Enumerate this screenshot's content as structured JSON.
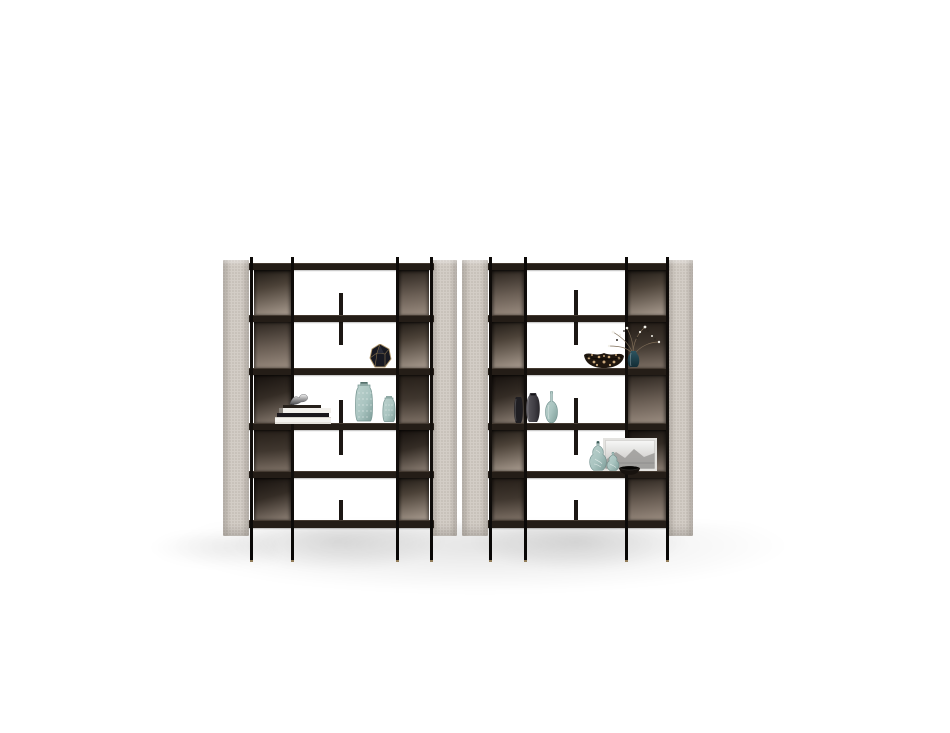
{
  "scene": {
    "type": "product-render",
    "subject": "Two modular open bookshelf units with upholstered side panels, bronze smoked-mirror back panels, slim black metal posts and staggered divider tabs, styled with decor objects, on a white studio background",
    "units_count": 2,
    "shelves_per_unit": 6,
    "rows_per_unit": 5,
    "posts_per_unit": 4,
    "divider_tabs_per_unit": 3
  },
  "colors": {
    "background": "#ffffff",
    "side_panel": "#d3cdc6",
    "side_panel_edge": "#b9b2aa",
    "shelf": "#241d17",
    "shelf_highlight": "#443a31",
    "post": "#14100d",
    "bronze_dark": "#1f1a15",
    "bronze_mid": "#6b5f55",
    "bronze_light": "#a3968a",
    "gold_trim": "#b49a6d",
    "teal_glass": "#a9c4c0",
    "teal_glass_dark": "#7e9d99",
    "charcoal_vase": "#4a484f",
    "leopard_base": "#20170f",
    "leopard_spot": "#c9a87c",
    "frame_border": "#e4e3e0",
    "book_white": "#f2f0ec",
    "book_black": "#1a171c"
  },
  "units": [
    {
      "id": "left-unit",
      "items": [
        "books_stack",
        "chrome_sculpture",
        "faceted_vase",
        "teal_vase_tall",
        "teal_vase_short"
      ]
    },
    {
      "id": "right-unit",
      "items": [
        "leopard_bowl",
        "branch_vase",
        "flat_black_vase",
        "charcoal_vase",
        "teal_bottle",
        "art_frame",
        "gourd_vase_tall",
        "gourd_vase_short",
        "black_bowl"
      ]
    }
  ],
  "item_labels": {
    "faceted_vase": "Dark faceted vase with brass edges",
    "chrome_sculpture": "Chrome figurine on stacked books",
    "books_stack": "Stack of coffee-table books",
    "teal_vase_tall": "Tall textured teal vase",
    "teal_vase_short": "Short textured teal vase",
    "leopard_bowl": "Animal-print ceramic bowl",
    "branch_vase": "Dark glass vase with dried blossom branches",
    "flat_black_vase": "Flat black vase",
    "charcoal_vase": "Round charcoal vase",
    "teal_bottle": "Teal glass bottle",
    "art_frame": "Framed monochrome landscape print",
    "gourd_vase_tall": "Tall teal gourd vase with branch motif",
    "gourd_vase_short": "Short teal gourd vase",
    "black_bowl": "Small black bowl"
  }
}
